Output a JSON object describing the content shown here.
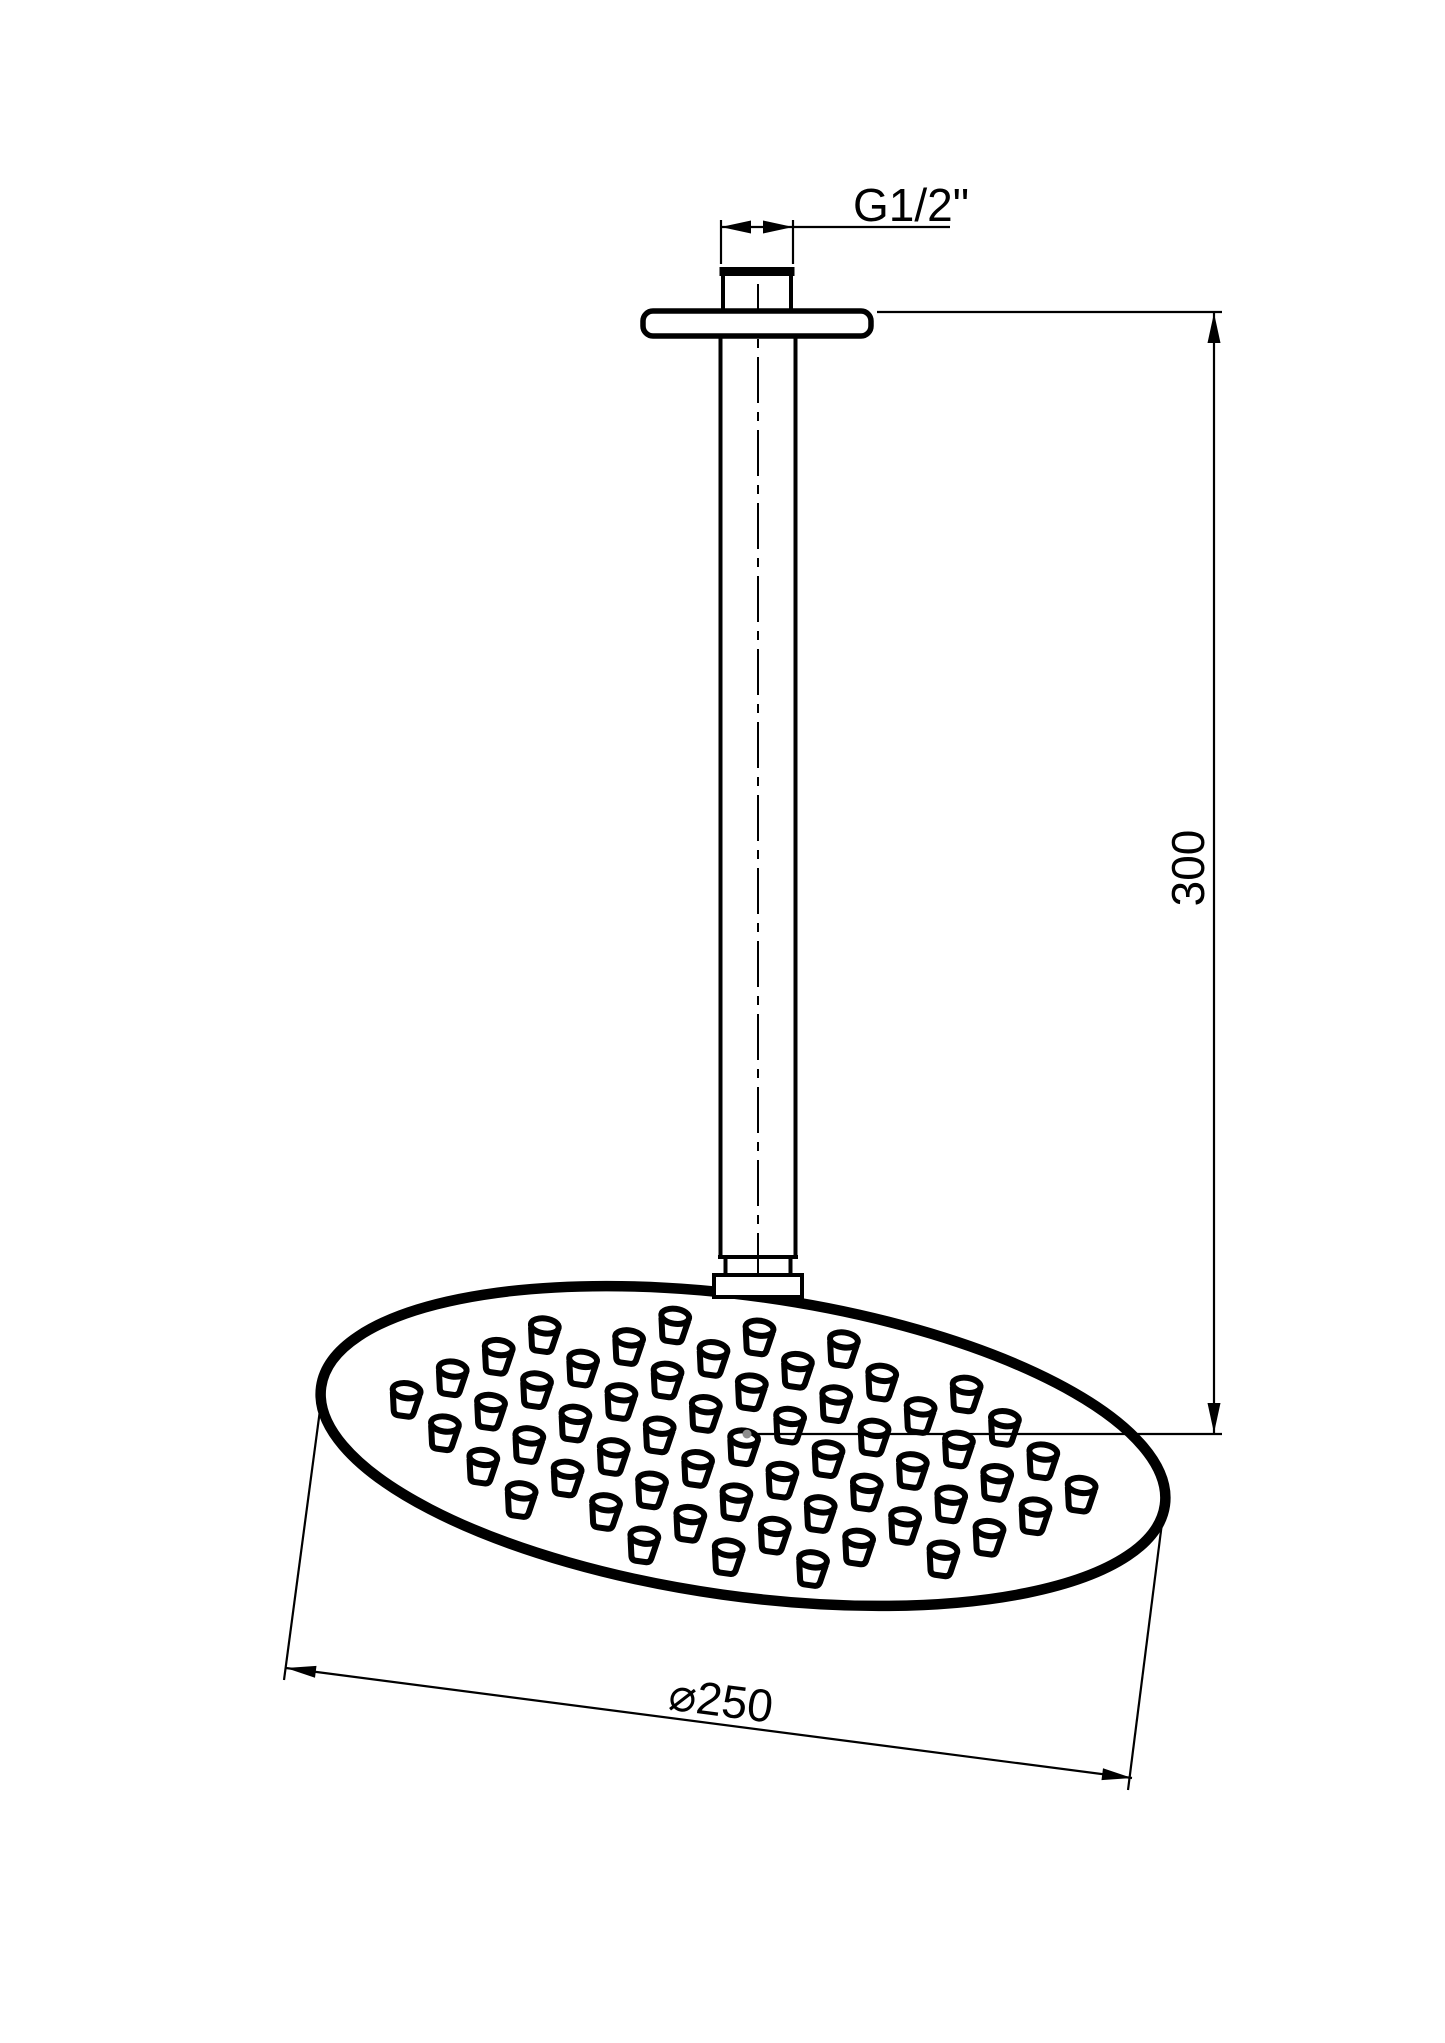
{
  "figure": {
    "type": "technical-drawing",
    "subject": "ceiling-mounted-round-shower-head",
    "background_color": "#ffffff",
    "line_color": "#000000",
    "marker_dot_color": "#8c8c8c"
  },
  "labels": {
    "thread_size": "G1/2\"",
    "arm_length": "300",
    "head_diameter": "⌀250"
  },
  "dimensions": [
    {
      "name": "connection-thread",
      "label": "G1/2\"",
      "orientation": "horizontal-leader"
    },
    {
      "name": "arm-drop-height",
      "label": "300",
      "orientation": "vertical",
      "rotation_deg": -90
    },
    {
      "name": "head-face-diameter",
      "label": "⌀250",
      "orientation": "slanted",
      "rotation_deg": 7.4
    }
  ],
  "drawing": {
    "canvas": {
      "width": 1445,
      "height": 2043
    },
    "head": {
      "center_x": 743,
      "center_y": 1446,
      "semi_major": 426,
      "semi_minor": 150,
      "tilt_deg": 8,
      "outline_stroke": 10.5
    },
    "nozzles": {
      "col_spacing": 0.2,
      "row_spacing": 0.185,
      "rows": 4,
      "cols": 5,
      "max_radius": 0.84
    }
  }
}
